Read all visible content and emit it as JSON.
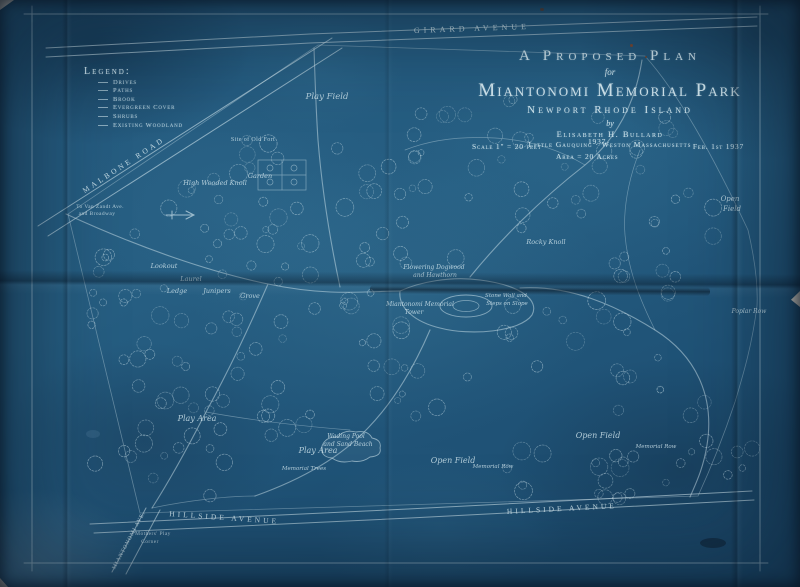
{
  "colors": {
    "ink": "#cfe4ec",
    "paper": "#235a7e",
    "paper_dark": "#143a57"
  },
  "title_block": {
    "line1": "A Proposed Plan",
    "line2": "for",
    "line3": "Miantonomi Memorial Park",
    "line4": "Newport Rhode Island",
    "by": "by",
    "author": "Elisabeth H. Bullard",
    "firm": "Little Gauquing · Weston Massachusetts",
    "scale": "Scale 1\" = 20 feet",
    "year": "1937",
    "date": "Feb. 1st 1937",
    "area": "Area = 20 Acres"
  },
  "legend": {
    "heading": "Legend:",
    "items": [
      "Drives",
      "Paths",
      "Brook",
      "Evergreen Cover",
      "Shrubs",
      "Existing Woodland"
    ]
  },
  "map_labels": [
    {
      "text": "Girard  Avenue",
      "x": 472,
      "y": 31,
      "size": 8,
      "rot": -2,
      "cls": "street",
      "ls": 4
    },
    {
      "text": "Malbone  Road",
      "x": 125,
      "y": 167,
      "size": 7.5,
      "rot": -33,
      "cls": "street",
      "ls": 3
    },
    {
      "text": "Hillside  Avenue",
      "x": 224,
      "y": 520,
      "size": 7.5,
      "rot": 4,
      "cls": "street",
      "ls": 3
    },
    {
      "text": "Hillside  Avenue",
      "x": 562,
      "y": 511,
      "size": 7.5,
      "rot": -3,
      "cls": "street",
      "ls": 3
    },
    {
      "text": "Miantonomi Ave.",
      "x": 130,
      "y": 541,
      "size": 5.5,
      "rot": -62,
      "cls": "street",
      "ls": 1
    },
    {
      "text": "To Van Zandt Ave.",
      "x": 100,
      "y": 208,
      "size": 5.5,
      "rot": 0,
      "cls": "print"
    },
    {
      "text": "and Broadway",
      "x": 97,
      "y": 215,
      "size": 5.5,
      "rot": 0,
      "cls": "print"
    },
    {
      "text": "Site of Old Fort",
      "x": 253,
      "y": 141,
      "size": 6,
      "rot": 0,
      "cls": "print"
    },
    {
      "text": "Mothers' Play",
      "x": 153,
      "y": 535,
      "size": 5.5,
      "rot": 0,
      "cls": "print"
    },
    {
      "text": "Corner",
      "x": 150,
      "y": 543,
      "size": 5.5,
      "rot": 0,
      "cls": "print"
    },
    {
      "text": "Play Field",
      "x": 327,
      "y": 99,
      "size": 8.5,
      "rot": 0,
      "cls": "script"
    },
    {
      "text": "High Wooded Knoll",
      "x": 215,
      "y": 185,
      "size": 6.5,
      "rot": 0,
      "cls": "script"
    },
    {
      "text": "Garden",
      "x": 260,
      "y": 178,
      "size": 6.5,
      "rot": 0,
      "cls": "script"
    },
    {
      "text": "Lookout",
      "x": 164,
      "y": 268,
      "size": 6.5,
      "rot": 0,
      "cls": "script"
    },
    {
      "text": "Laurel",
      "x": 191,
      "y": 281,
      "size": 6.5,
      "rot": 0,
      "cls": "script"
    },
    {
      "text": "Ledge",
      "x": 177,
      "y": 293,
      "size": 6.5,
      "rot": 0,
      "cls": "script"
    },
    {
      "text": "Junipers",
      "x": 217,
      "y": 293,
      "size": 6.5,
      "rot": 0,
      "cls": "script"
    },
    {
      "text": "Grove",
      "x": 250,
      "y": 298,
      "size": 6.5,
      "rot": 0,
      "cls": "script"
    },
    {
      "text": "Flowering Dogwood",
      "x": 434,
      "y": 269,
      "size": 6,
      "rot": 0,
      "cls": "script"
    },
    {
      "text": "and Hawthorn",
      "x": 435,
      "y": 277,
      "size": 6,
      "rot": 0,
      "cls": "script"
    },
    {
      "text": "Miantonomi Memorial",
      "x": 420,
      "y": 306,
      "size": 6,
      "rot": 0,
      "cls": "script"
    },
    {
      "text": "Tower",
      "x": 414,
      "y": 314,
      "size": 6,
      "rot": 0,
      "cls": "script"
    },
    {
      "text": "Stone Wall and",
      "x": 506,
      "y": 297,
      "size": 5.5,
      "rot": 0,
      "cls": "script"
    },
    {
      "text": "Steps on Slope",
      "x": 507,
      "y": 305,
      "size": 5.5,
      "rot": 0,
      "cls": "script"
    },
    {
      "text": "Rocky Knoll",
      "x": 546,
      "y": 244,
      "size": 6.5,
      "rot": 0,
      "cls": "script"
    },
    {
      "text": "Wading Pool",
      "x": 346,
      "y": 438,
      "size": 6,
      "rot": 0,
      "cls": "script"
    },
    {
      "text": "and Sand Beach",
      "x": 348,
      "y": 446,
      "size": 6,
      "rot": 0,
      "cls": "script"
    },
    {
      "text": "Play Area",
      "x": 318,
      "y": 453,
      "size": 8,
      "rot": 0,
      "cls": "script"
    },
    {
      "text": "Play Area",
      "x": 197,
      "y": 421,
      "size": 8,
      "rot": 0,
      "cls": "script"
    },
    {
      "text": "Memorial Trees",
      "x": 304,
      "y": 470,
      "size": 5.5,
      "rot": 0,
      "cls": "script"
    },
    {
      "text": "Memorial Row",
      "x": 493,
      "y": 468,
      "size": 5.5,
      "rot": 0,
      "cls": "script"
    },
    {
      "text": "Open Field",
      "x": 453,
      "y": 463,
      "size": 8,
      "rot": 0,
      "cls": "script"
    },
    {
      "text": "Open Field",
      "x": 598,
      "y": 438,
      "size": 8,
      "rot": 0,
      "cls": "script"
    },
    {
      "text": "Memorial Row",
      "x": 656,
      "y": 448,
      "size": 5.5,
      "rot": 0,
      "cls": "script"
    },
    {
      "text": "Open",
      "x": 730,
      "y": 201,
      "size": 7,
      "rot": 0,
      "cls": "script"
    },
    {
      "text": "Field",
      "x": 732,
      "y": 211,
      "size": 7,
      "rot": 0,
      "cls": "script"
    },
    {
      "text": "Poplar Row",
      "x": 749,
      "y": 313,
      "size": 6,
      "rot": 0,
      "cls": "script"
    }
  ]
}
